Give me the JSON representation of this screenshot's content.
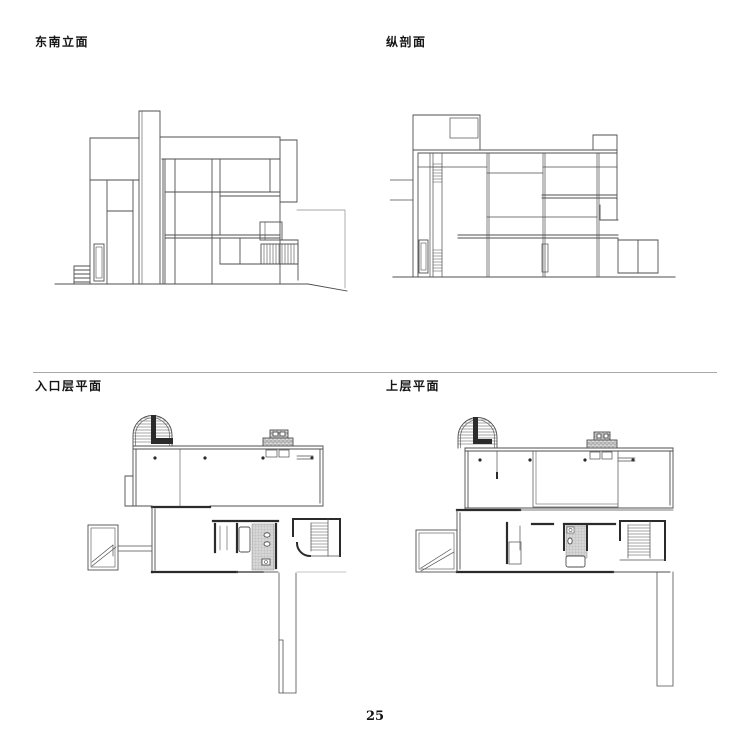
{
  "page": {
    "number": "25",
    "background_color": "#ffffff",
    "line_color": "#4f4f4f",
    "heavy_wall_color": "#2b2b2b"
  },
  "figures": [
    {
      "id": "southeast-elevation",
      "label": "东南立面"
    },
    {
      "id": "longitudinal-section",
      "label": "纵剖面"
    },
    {
      "id": "entrance-level-plan",
      "label": "入口层平面"
    },
    {
      "id": "upper-level-plan",
      "label": "上层平面"
    }
  ]
}
